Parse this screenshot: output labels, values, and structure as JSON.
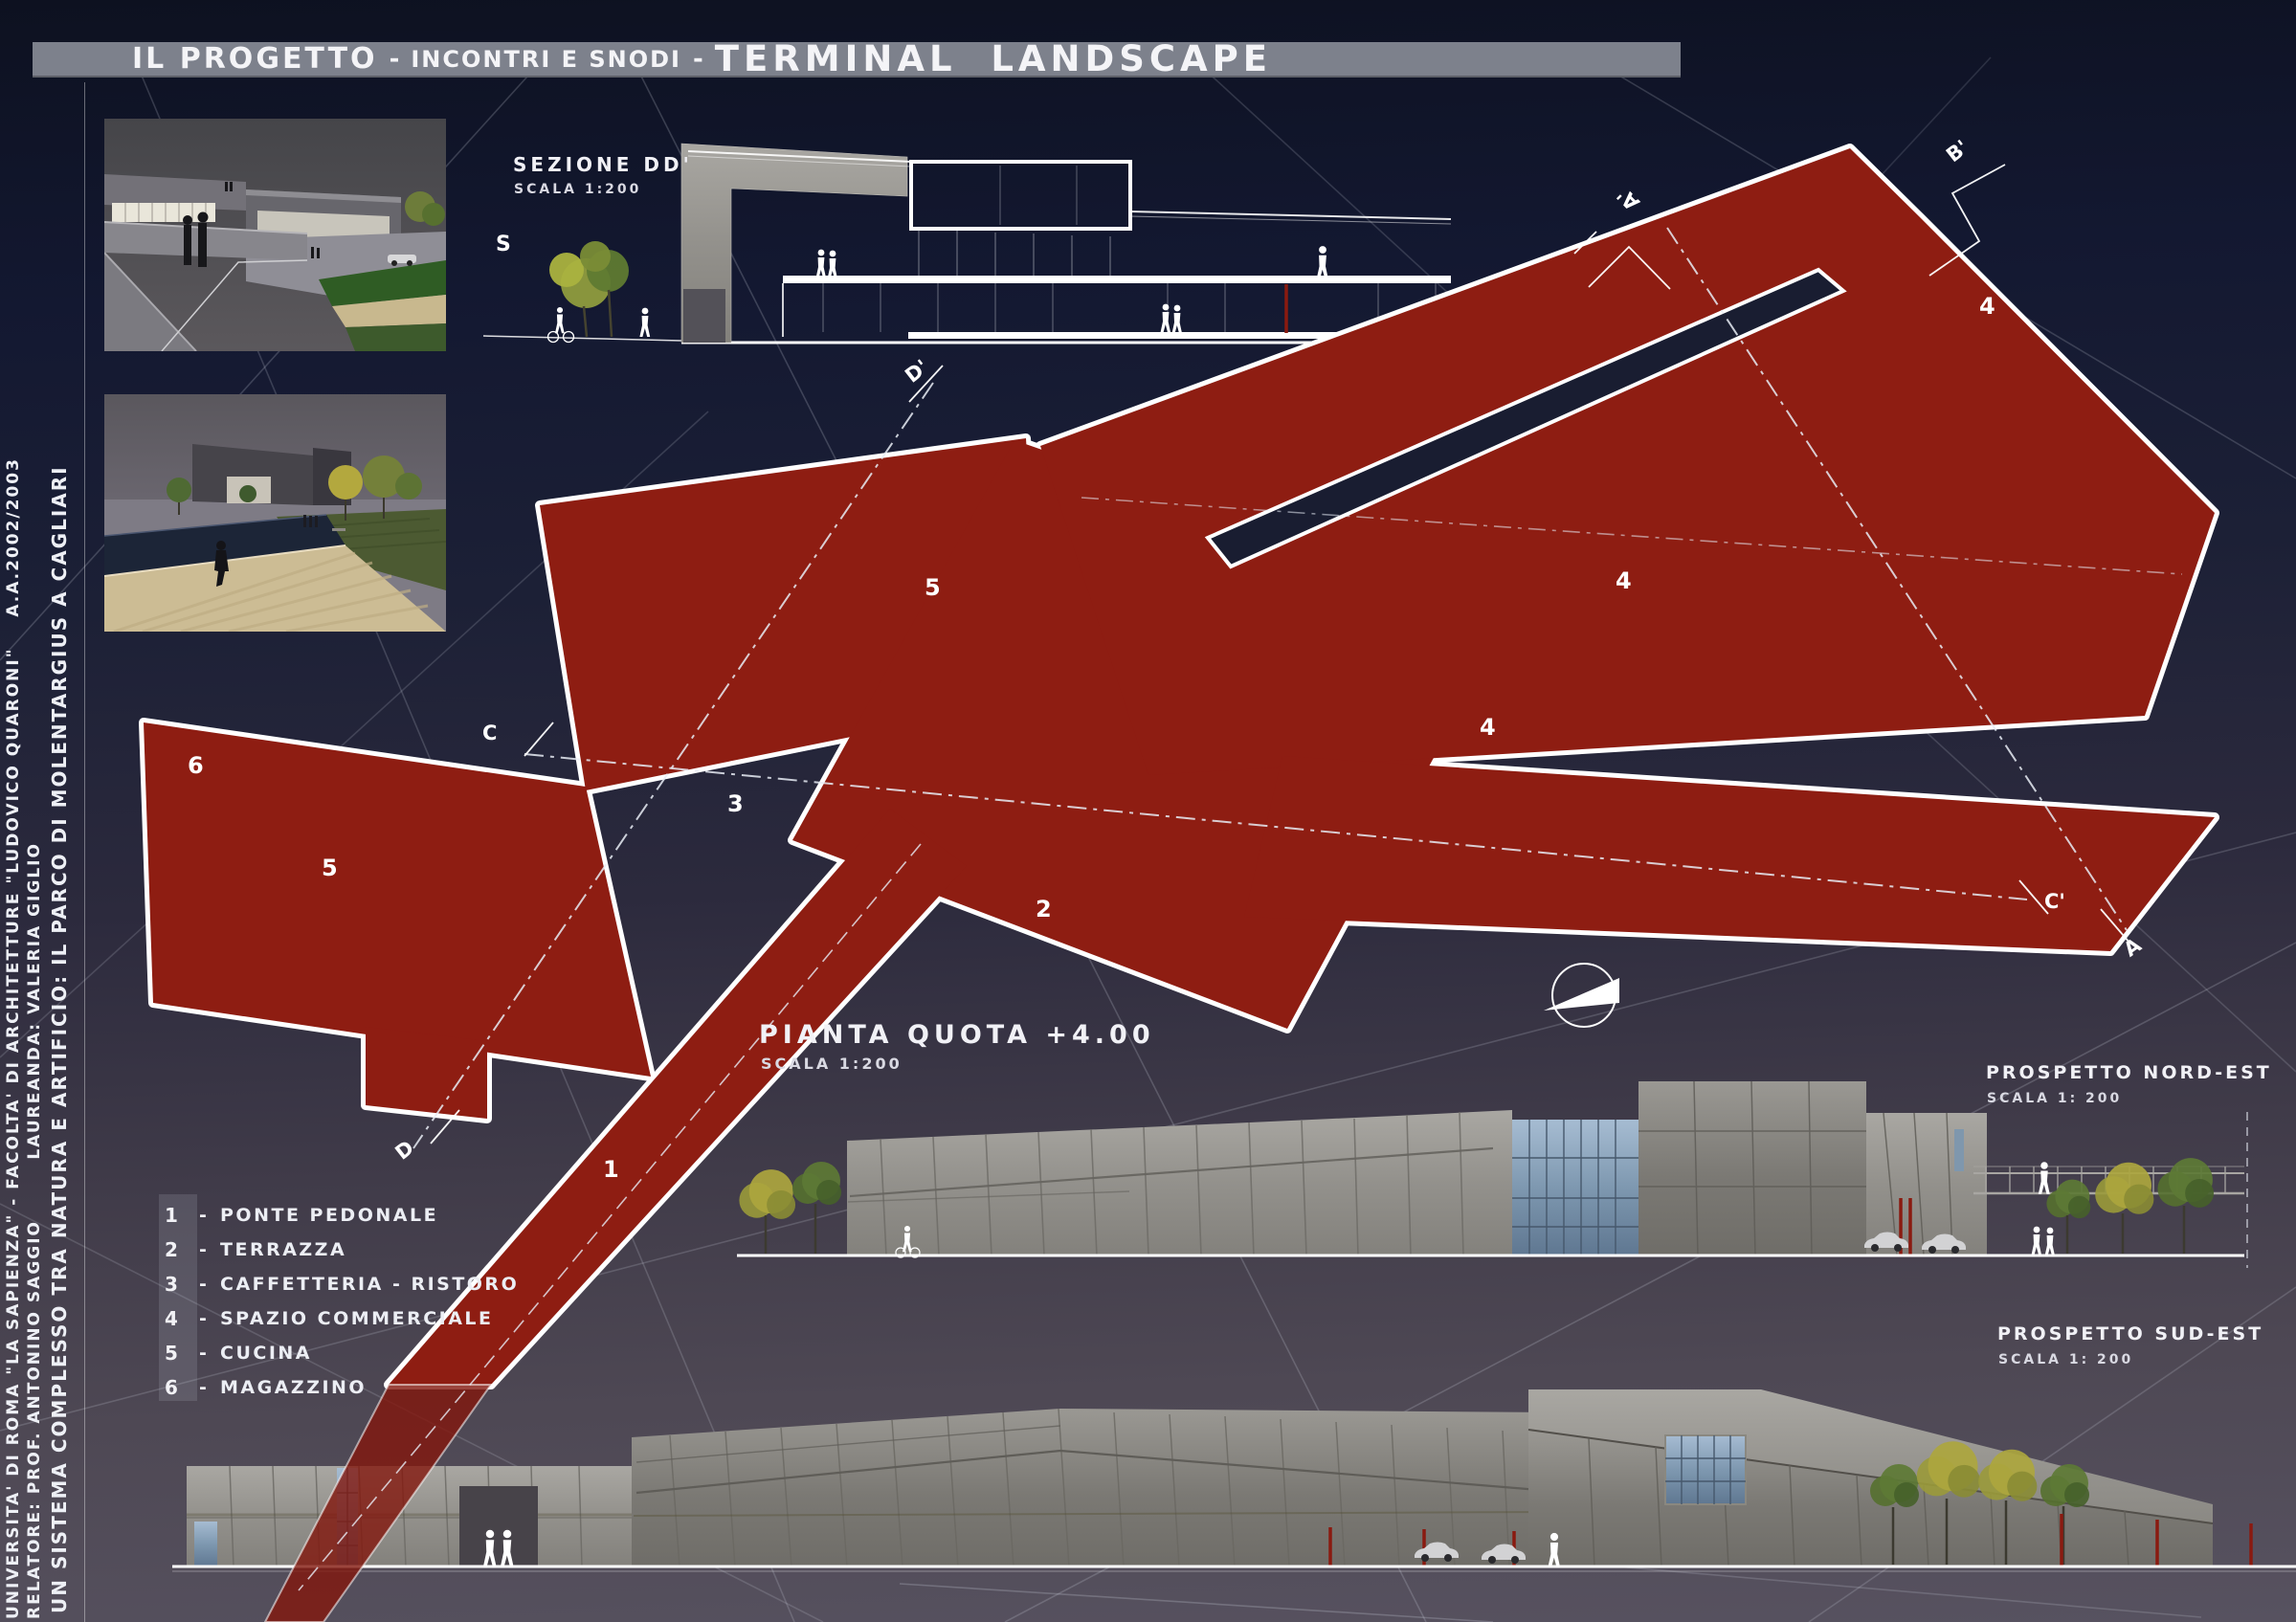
{
  "title": {
    "part1": "IL PROGETTO",
    "sep1": "-",
    "part2": "INCONTRI E SNODI",
    "sep2": "-",
    "part3": "TERMINAL  LANDSCAPE"
  },
  "credits": {
    "line1": "UNIVERSITA' DI ROMA \"LA SAPIENZA\" - FACOLTA' DI ARCHITETTURE \"LUDOVICO QUARONI\"    A.A.2002/2003",
    "line2": "RELATORE: PROF. ANTONINO SAGGIO        LAUREANDA: VALERIA GIGLIO",
    "line3": "UN SISTEMA COMPLESSO TRA NATURA E ARTIFICIO: IL PARCO DI MOLENTARGIUS A CAGLIARI"
  },
  "labels": {
    "sezione": {
      "title": "SEZIONE DD'",
      "scale": "SCALA 1:200"
    },
    "pianta": {
      "title": "PIANTA QUOTA +4.00",
      "scale": "SCALA 1:200"
    },
    "prospetto_nord_est": {
      "title": "PROSPETTO NORD-EST",
      "scale": "SCALA 1: 200"
    },
    "prospetto_sud_est": {
      "title": "PROSPETTO SUD-EST",
      "scale": "SCALA 1: 200"
    }
  },
  "legend": {
    "items": [
      {
        "num": "1",
        "sep": "-",
        "label": "PONTE PEDONALE"
      },
      {
        "num": "2",
        "sep": "-",
        "label": "TERRAZZA"
      },
      {
        "num": "3",
        "sep": "-",
        "label": "CAFFETTERIA - RISTORO"
      },
      {
        "num": "4",
        "sep": "-",
        "label": "SPAZIO COMMERCIALE"
      },
      {
        "num": "5",
        "sep": "-",
        "label": "CUCINA"
      },
      {
        "num": "6",
        "sep": "-",
        "label": "MAGAZZINO"
      }
    ]
  },
  "plan": {
    "numbers": {
      "ponte": "1",
      "terrazza": "2",
      "caffetteria": "3",
      "commerciale": "4",
      "cucina": "5",
      "magazzino": "6"
    },
    "markers": {
      "s": "S",
      "a_prime": "A'",
      "a": "A",
      "b_prime": "B'",
      "c": "C",
      "c_prime": "C'",
      "d_prime": "D'",
      "d": "D"
    }
  },
  "colors": {
    "background_top": "#0d1120",
    "background_bottom": "#575260",
    "titlebar_gray": "#7d818c",
    "plan_red": "#8e1d12",
    "bridge_red_overlay": "rgba(130,22,12,0.8)",
    "accent_red": "#8a1a10",
    "concrete": "#93918c",
    "glass_blue": "#7e98b0",
    "line_white": "#ffffff"
  }
}
